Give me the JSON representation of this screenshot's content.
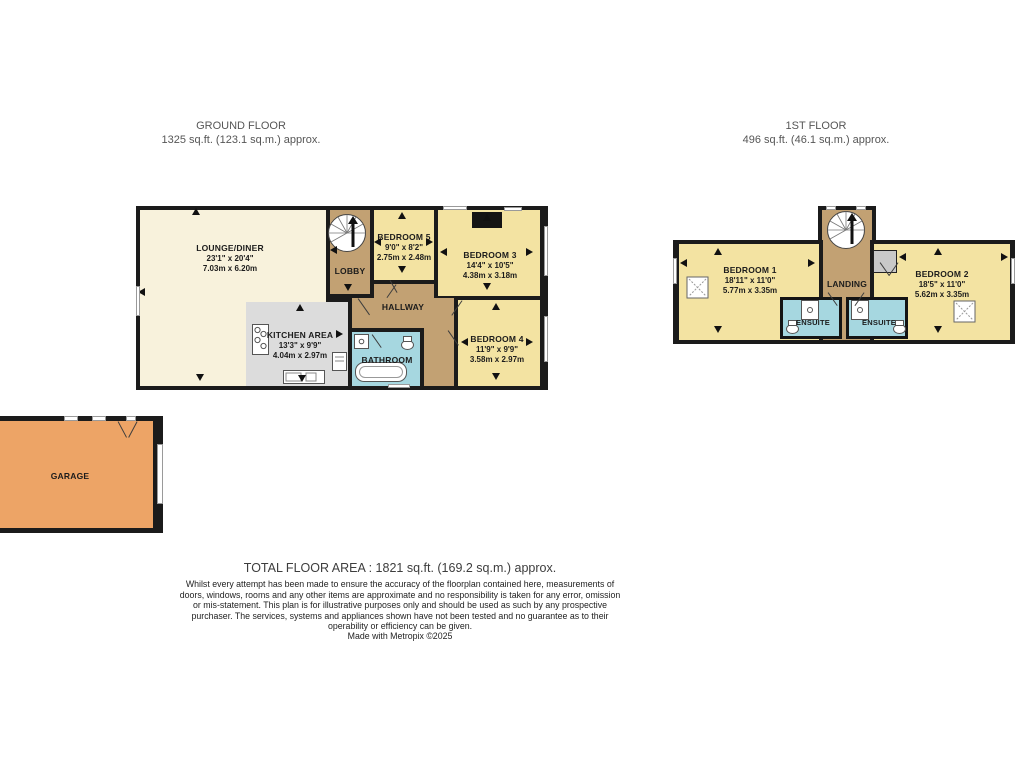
{
  "ground_floor": {
    "title": "GROUND FLOOR",
    "area": "1325 sq.ft. (123.1 sq.m.) approx.",
    "rooms": {
      "lounge": {
        "name": "LOUNGE/DINER",
        "dims_ft": "23'1\" x 20'4\"",
        "dims_m": "7.03m x 6.20m"
      },
      "kitchen": {
        "name": "KITCHEN AREA",
        "dims_ft": "13'3\" x 9'9\"",
        "dims_m": "4.04m x 2.97m"
      },
      "lobby": {
        "name": "LOBBY"
      },
      "bedroom5": {
        "name": "BEDROOM 5",
        "dims_ft": "9'0\" x 8'2\"",
        "dims_m": "2.75m x 2.48m"
      },
      "bedroom3": {
        "name": "BEDROOM 3",
        "dims_ft": "14'4\" x 10'5\"",
        "dims_m": "4.38m x 3.18m"
      },
      "hallway": {
        "name": "HALLWAY"
      },
      "bathroom": {
        "name": "BATHROOM"
      },
      "bedroom4": {
        "name": "BEDROOM 4",
        "dims_ft": "11'9\" x 9'9\"",
        "dims_m": "3.58m x 2.97m"
      }
    }
  },
  "first_floor": {
    "title": "1ST FLOOR",
    "area": "496 sq.ft. (46.1 sq.m.) approx.",
    "rooms": {
      "bedroom1": {
        "name": "BEDROOM 1",
        "dims_ft": "18'11\" x 11'0\"",
        "dims_m": "5.77m x 3.35m"
      },
      "landing": {
        "name": "LANDING"
      },
      "bedroom2": {
        "name": "BEDROOM 2",
        "dims_ft": "18'5\" x 11'0\"",
        "dims_m": "5.62m x 3.35m"
      },
      "ensuite_left": {
        "name": "ENSUITE"
      },
      "ensuite_right": {
        "name": "ENSUITE"
      }
    }
  },
  "garage": {
    "name": "GARAGE"
  },
  "footer": {
    "total_area": "TOTAL FLOOR AREA : 1821 sq.ft. (169.2 sq.m.) approx.",
    "disclaimer": "Whilst every attempt has been made to ensure the accuracy of the floorplan contained here, measurements of doors, windows, rooms and any other items are approximate and no responsibility is taken for any error, omission or mis-statement. This plan is for illustrative purposes only and should be used as such by any prospective purchaser. The services, systems and appliances shown have not been tested and no guarantee as to their operability or efficiency can be given.",
    "credit": "Made with Metropix ©2025"
  },
  "colors": {
    "wall": "#1b1b1b",
    "lounge_cream": "#f8f2dc",
    "bedroom_yellow": "#f3e3a2",
    "hall_tan": "#c2a173",
    "wet_blue": "#a6d7e0",
    "garage_orange": "#eda466",
    "kitchen_floor_gray": "#dcdcdc",
    "title_gray": "#565656"
  }
}
